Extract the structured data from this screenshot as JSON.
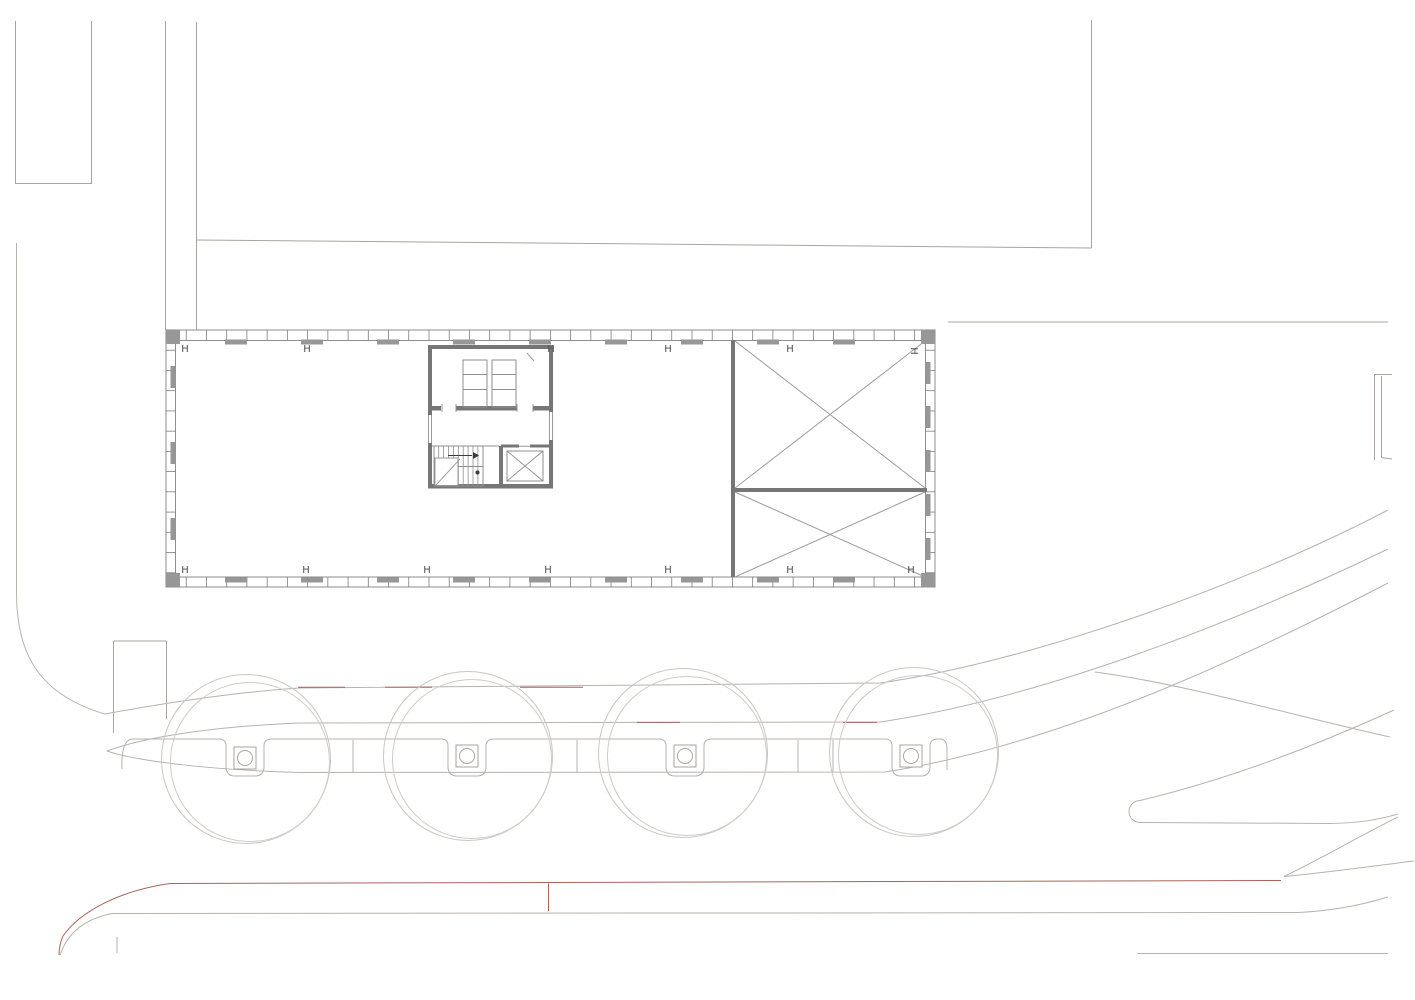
{
  "title": "site-floor-plan",
  "palette": {
    "background": "#ffffff",
    "wall": "#767676",
    "thin": "#8f8f8f",
    "outline": "#8e8e8e",
    "pier": "#979797",
    "tick": "#7d7d7d",
    "brace": "#9c9c9c",
    "site": "#aaa49e",
    "street": "#b7b2ad",
    "tree": "#cbc7c3",
    "tree_inner": "#cfcbc7",
    "grate": "#aaa49f",
    "red": "#a8655c",
    "text": "#4f4f4f"
  },
  "column_markers": {
    "glyph": "H",
    "font_size": 10,
    "top_row": {
      "y": 352,
      "xs": [
        185,
        307,
        551,
        668,
        790
      ]
    },
    "top_rotated": {
      "x": 911,
      "y": 348
    },
    "bottom_row": {
      "y": 573,
      "xs": [
        185,
        306,
        427,
        548,
        668,
        790,
        911
      ]
    }
  },
  "facade": {
    "outer": [
      166,
      330,
      769,
      257
    ],
    "inner": [
      175.5,
      340.5,
      750,
      236.5
    ],
    "tick_step": 20.23,
    "piers_top_xs": [
      225,
      301,
      377,
      453,
      529,
      605,
      681,
      757,
      833
    ],
    "piers_bottom_xs": [
      225,
      301,
      377,
      453,
      529,
      605,
      681,
      757,
      833
    ],
    "piers_left_ys": [
      366,
      442,
      518
    ],
    "piers_right_ys": [
      362,
      406,
      450,
      494,
      538
    ],
    "corner_piers": [
      [
        166,
        330,
        14,
        14
      ],
      [
        921,
        330,
        14,
        14
      ],
      [
        166,
        573,
        14,
        14
      ],
      [
        921,
        573,
        14,
        14
      ]
    ]
  },
  "core": {
    "walls": [
      [
        428,
        345,
        125,
        4
      ],
      [
        428,
        349,
        4,
        139
      ],
      [
        549,
        349,
        4,
        139
      ],
      [
        428,
        484,
        125,
        4.5
      ],
      [
        430,
        406,
        11,
        4.5
      ],
      [
        456,
        406,
        61,
        4.5
      ],
      [
        533,
        406,
        16,
        4.5
      ],
      [
        499,
        446,
        4,
        40
      ],
      [
        501,
        444.5,
        18,
        3
      ],
      [
        530,
        444.5,
        19,
        3
      ]
    ],
    "window_gaps": [
      [
        427.5,
        415,
        5,
        28
      ],
      [
        548.5,
        412,
        5,
        28
      ]
    ],
    "window_lines": [
      "M 428.5,415 L 428.5,443",
      "M 431.5,415 L 431.5,443",
      "M 549.5,412 L 549.5,440",
      "M 552.5,412 L 552.5,440"
    ],
    "thin_rects": [
      [
        463,
        360,
        24,
        47
      ],
      [
        492,
        360,
        24,
        47
      ],
      [
        434,
        446,
        49,
        40
      ],
      [
        507,
        451,
        36,
        30
      ]
    ],
    "thin_paths": [
      "M 463,374.5 L 487,374.5",
      "M 463,389.5 L 487,389.5",
      "M 492,374.5 L 516,374.5",
      "M 492,389.5 L 516,389.5",
      "M 527,353 L 534,361",
      "M 432,446 L 499,446",
      "M 519,446.2 L 531,446.2",
      "M 507,451 L 543,481",
      "M 543,451 L 507,481",
      "M 442,404 L 442,412",
      "M 456,404 L 456,412",
      "M 517,404 L 517,412",
      "M 533,404 L 533,412"
    ],
    "stair": {
      "treads": {
        "x0": 438.7,
        "step": 4.9,
        "n": 9,
        "y1": 446,
        "y2": 486
      },
      "landing_rect": [
        435,
        458,
        23,
        27.5
      ],
      "landing_diag": "M 436,485 L 460,459",
      "mid_line": "M 458,466.5 L 483,466.5",
      "arrow_line": [
        448,
        455.5,
        472,
        455.5
      ],
      "arrow_head": "473,452 479,455.5 473,459",
      "dot": [
        477.5,
        472.5,
        2
      ]
    }
  },
  "braced_rooms": {
    "walls": [
      [
        731,
        340,
        4,
        237
      ],
      [
        731,
        488,
        196,
        4
      ]
    ],
    "x_lines": [
      "M 735,341 L 925,488",
      "M 925,341 L 735,488",
      "M 735,492 L 925,577",
      "M 925,492 L 735,577"
    ]
  },
  "trees": {
    "outer_r": 84.5,
    "inner_r": 79.5,
    "inner_offset": [
      4,
      3
    ],
    "square_size": 22,
    "grate_r": 7.5,
    "centers": [
      [
        246,
        759
      ],
      [
        468,
        756
      ],
      [
        683,
        753
      ],
      [
        914,
        752
      ]
    ],
    "square_centers": [
      [
        245,
        758
      ],
      [
        467,
        756
      ],
      [
        685,
        756
      ],
      [
        911,
        756
      ]
    ]
  },
  "site_paths": [
    "M 15.5,21 L 15.5,183.5 L 91.5,183.5 L 91.5,21",
    "M 165.5,21 L 165.5,330",
    "M 196.5,22 L 196.5,330",
    "M 196.5,240 L 1091.5,248",
    "M 1091.5,20 L 1091.5,248",
    "M 948,322 L 1388,322",
    "M 1374.5,374 L 1374.5,460",
    "M 1381.5,376 L 1381.5,457",
    "M 1374,374.5 L 1392,374.5",
    "M 1381,457.5 L 1392,459",
    "M 113.5,641 L 113.5,733",
    "M 166.5,641 L 166.5,719",
    "M 113.5,641 L 166.5,641"
  ],
  "street_paths": [
    "M 16.5,243 L 16.5,595 C 17,655 40,695 105,714 C 165,703 235,692 300,688 L 880,683 C 1030,662 1245,585 1388,510",
    "M 107,751 C 150,735 225,726 300,723 L 880,722 C 1045,698 1245,618 1388,549",
    "M 107,751 C 135,761 210,770 300,772.5 L 885,772 C 1065,744 1255,652 1388,583",
    "M 1095,672 C 1185,684 1295,716 1390,737",
    "M 60,955 C 68,932 85,919 112,913.5 L 1297,912.5 C 1332,911 1362,905 1388,897",
    "M 117,937 L 117,953",
    "M 1137,953.5 L 1388,953.5",
    "M 1140,800.5 A 11,11 0 0 0 1140,822.5",
    "M 1140,800.5 C 1230,779 1312,747 1394,710",
    "M 1140,822.5 L 1330,823.5 C 1358,823 1378,820 1398,814",
    "M 1284,876.5 C 1322,858 1358,837 1398,817",
    "M 1284,876.5 C 1332,872 1372,866 1414,861"
  ],
  "sidewalk_strip": {
    "outline": "M 122,769 Q 121,740 132,739 L 220,739 Q 226,739.5 226,746 L 226,768 Q 227,775.5 234,776 L 256,776 Q 263,775.5 264,768 L 264,746 Q 264,739.5 271,739 L 442,739 Q 448,739.5 448,746 L 448,768 Q 449,775.5 456,776 L 478,776 Q 485,775.5 486,768 L 486,746 Q 486,739.5 493,739 L 660,739 Q 666,739.5 666,746 L 666,768 Q 667,775.5 674,776 L 696,776 Q 703,775.5 704,768 L 704,746 Q 704,739.5 711,739 L 886,739 Q 892,739.5 892,746 L 892,768 Q 893,775.5 900,776 L 922,776 Q 929,775.5 930,768 L 930,746 Q 930,739.5 937,739 L 941,739 Q 947,740 947,749 L 947,770",
    "joints": [
      "M 353,740 L 353,772",
      "M 577,740 L 577,772",
      "M 798,740 L 798,772",
      "M 833,740 L 833,772"
    ]
  },
  "red_paths": [
    "M 170,883.5 C 118,891 80,912 63,936 C 60,943 59,949 59,955",
    "M 170,883.5 L 1281,880.5",
    "M 548.5,883.5 L 548.5,911",
    "M 298,687.3 L 345,687.3",
    "M 385,687.3 L 432,687.3",
    "M 520,687.3 L 583,687.3",
    "M 637,722.4 L 680,722.4",
    "M 843,722.4 L 877,722.4"
  ]
}
